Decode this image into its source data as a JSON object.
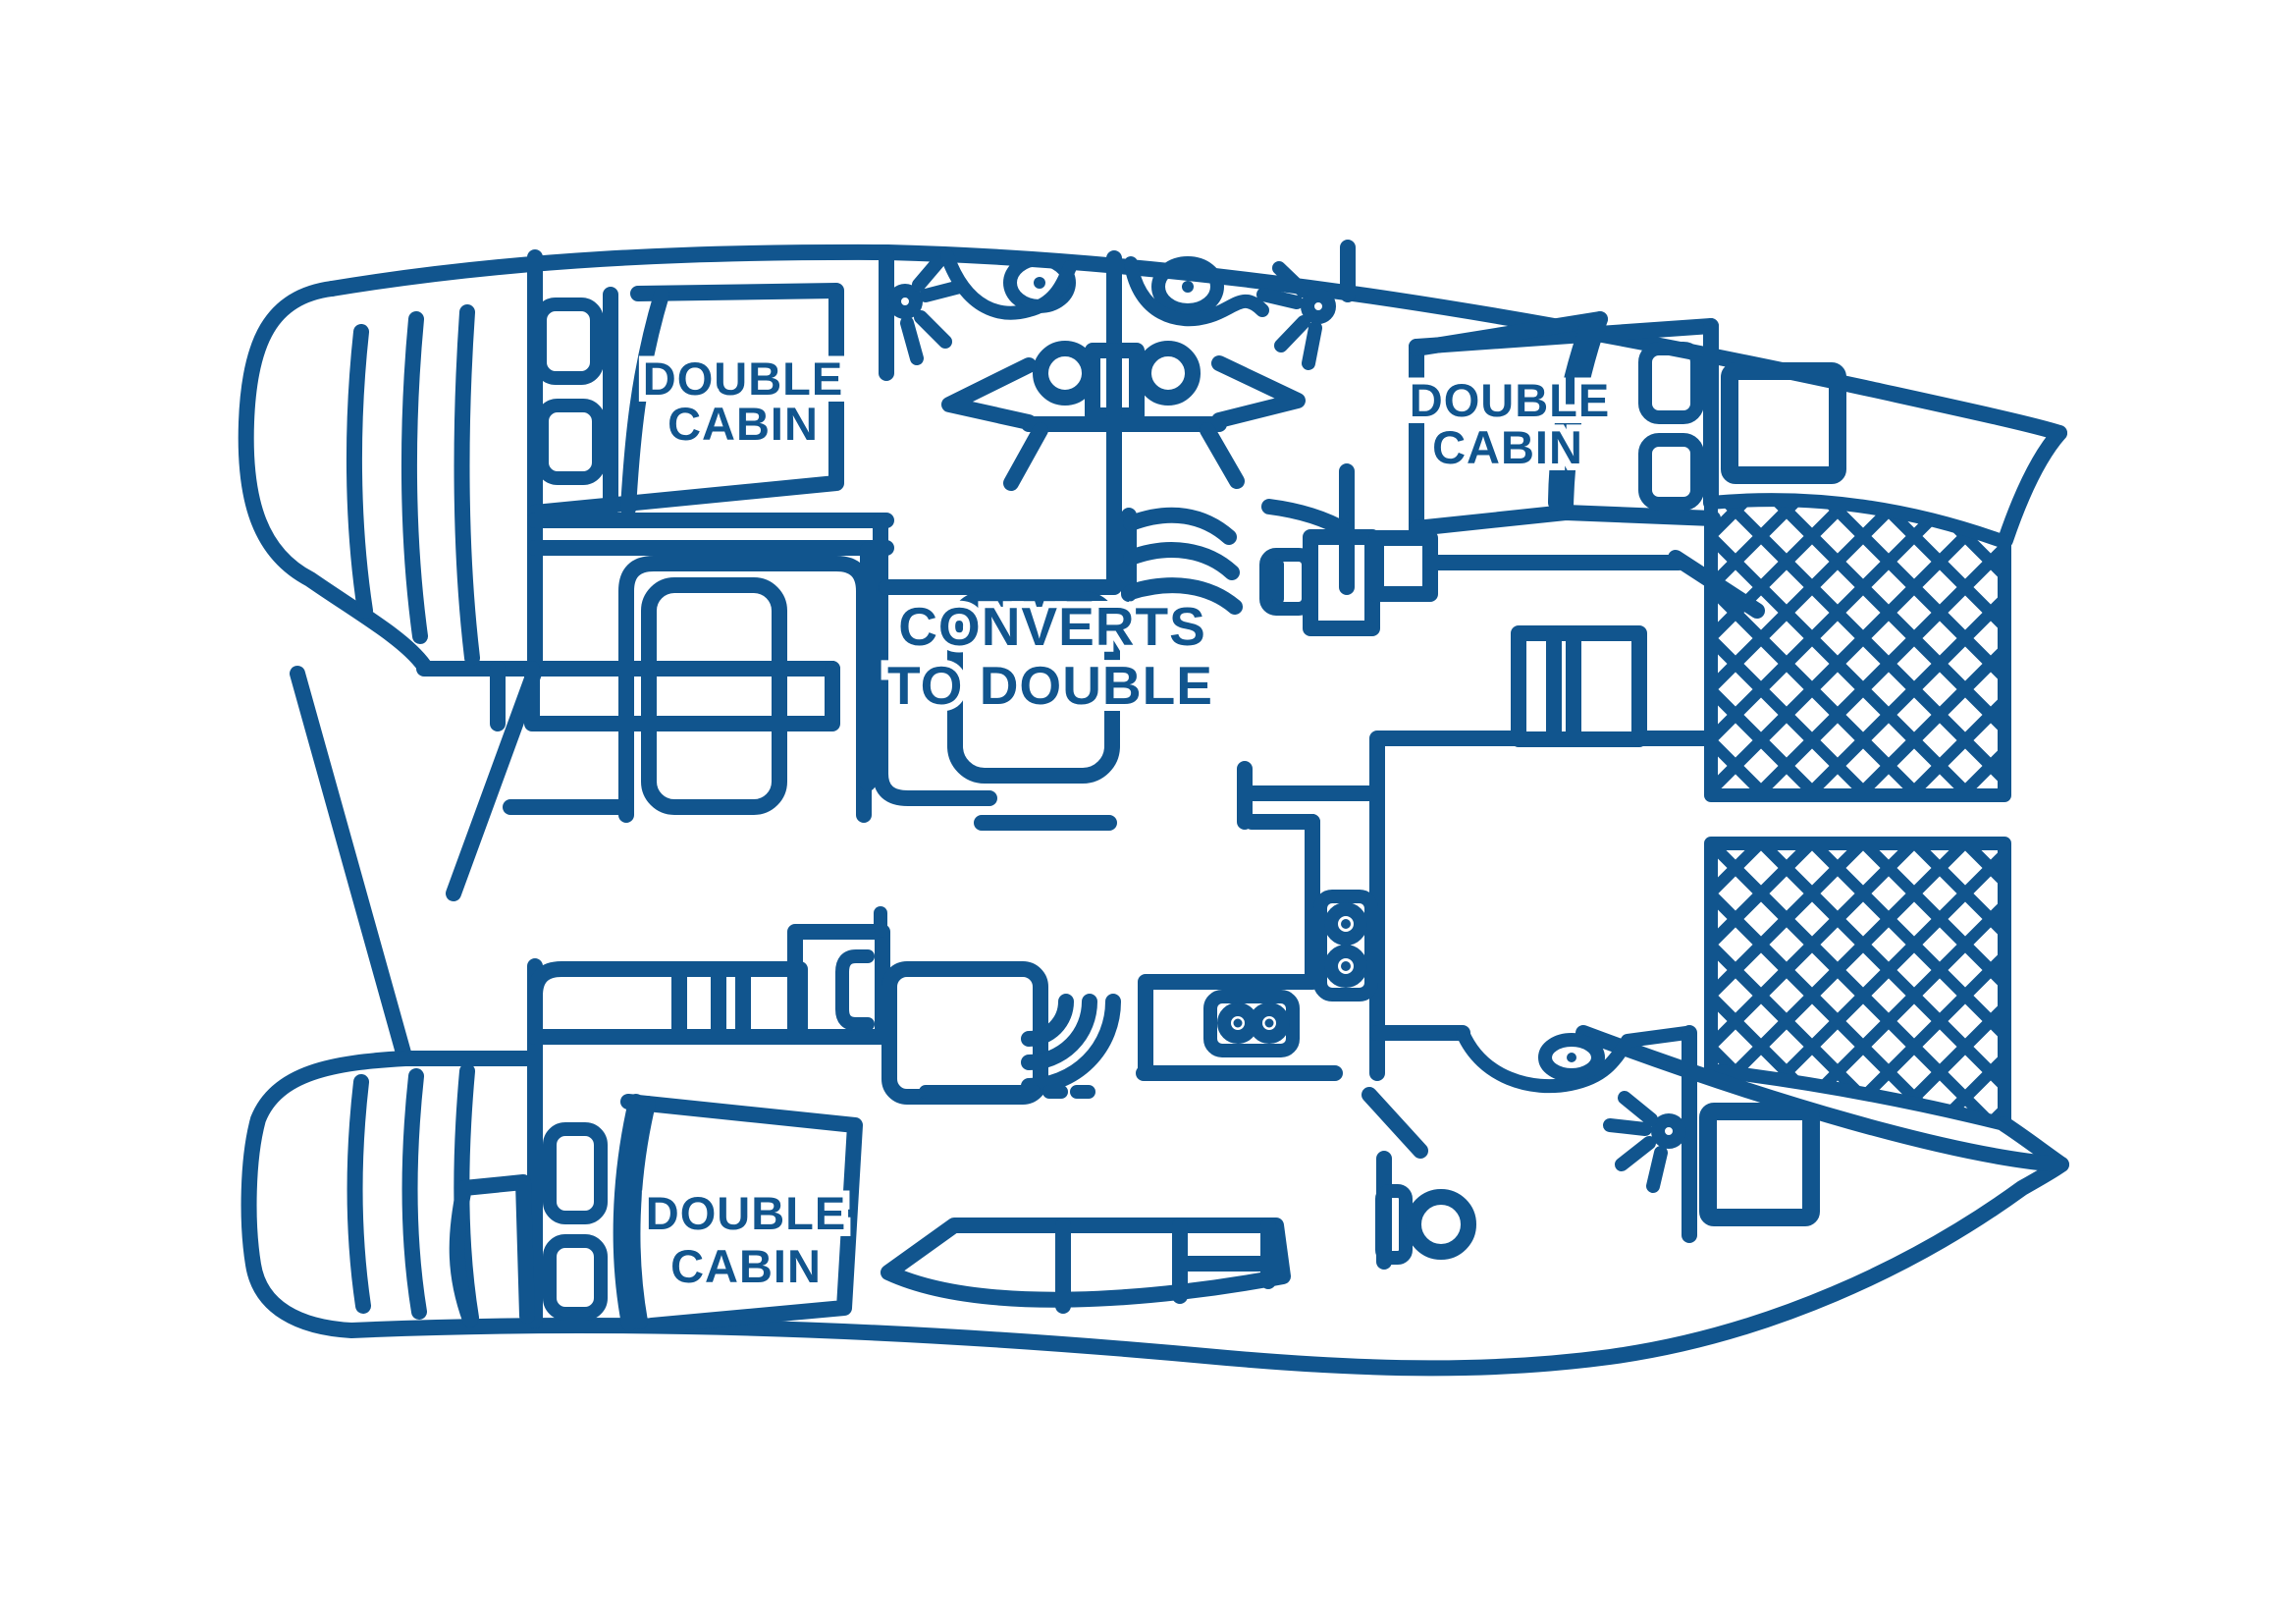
{
  "diagram": {
    "type": "boat-floorplan",
    "subject": "catamaran layout, bow to the right, twin hulls with bridge-deck salon and bow trampolines"
  },
  "colors": {
    "line": "#11558e",
    "background": "#ffffff"
  },
  "labels": {
    "cabin_top_aft": {
      "line1": "DOUBLE",
      "line2": "CABIN"
    },
    "cabin_top_forward": {
      "line1": "DOUBLE",
      "line2": "CABIN"
    },
    "cabin_bottom_aft": {
      "line1": "DOUBLE",
      "line2": "CABIN"
    },
    "salon": {
      "line1": "CONVERTS",
      "line2": "TO DOUBLE"
    }
  }
}
